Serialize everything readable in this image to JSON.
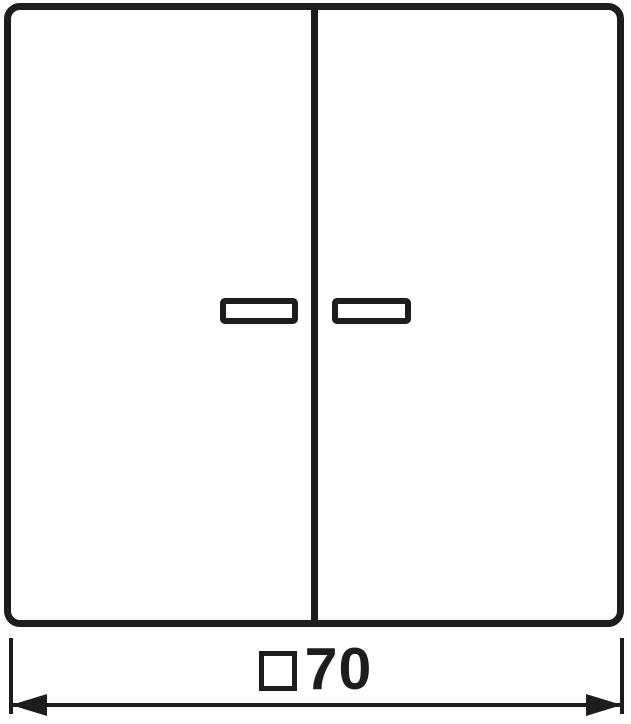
{
  "drawing": {
    "kind": "technical-dimension-drawing",
    "subject": "two-rocker-switch-cover-with-indicator-windows",
    "rocker_count": 2,
    "indicator_window_count": 2
  },
  "dimension": {
    "symbol_icon": "square-outline-symbol",
    "value": "70"
  },
  "colors": {
    "line": "#1d1d1b",
    "background": "#ffffff"
  }
}
